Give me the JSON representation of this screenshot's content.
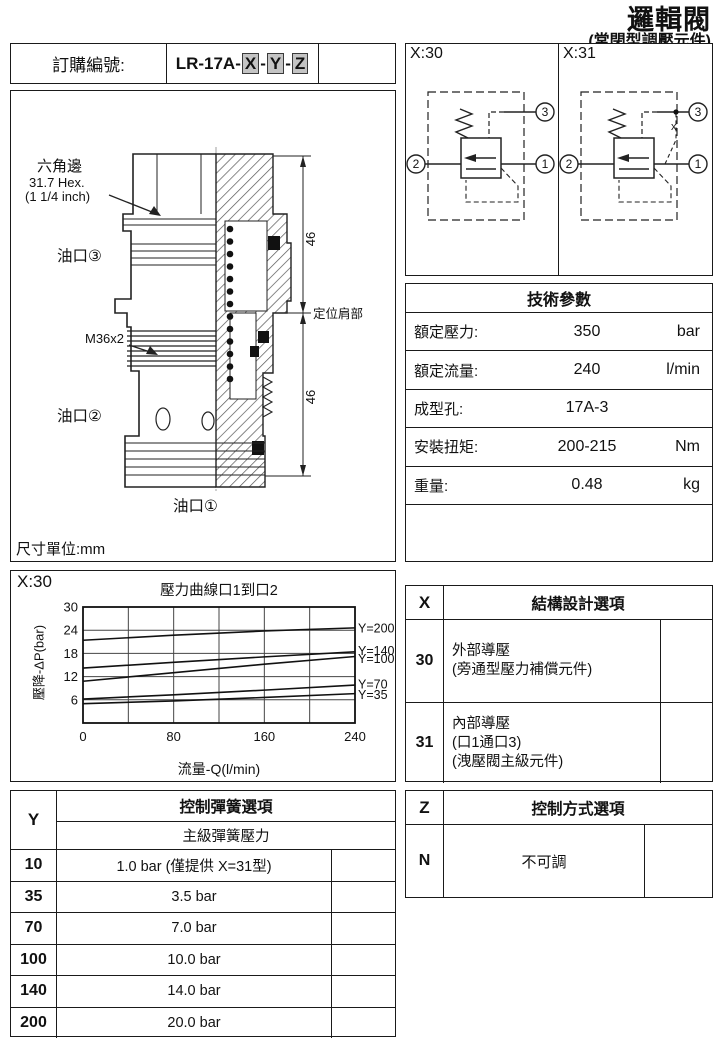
{
  "page": {
    "title": "邏輯閥",
    "subtitle": "(常閉型調壓元件)"
  },
  "order": {
    "label": "訂購編號:",
    "code_prefix": "LR-17A-",
    "code_x": "X",
    "sep1": "-",
    "code_y": "Y",
    "sep2": "-",
    "code_z": "Z"
  },
  "drawing": {
    "hex_label_line1": "六角邊",
    "hex_label_line2": "31.7 Hex.",
    "hex_label_line3": "(1 1/4 inch)",
    "thread_label": "M36x2",
    "port3_label": "油口③",
    "port2_label": "油口②",
    "port1_label": "油口①",
    "dim_top": "46",
    "dim_bottom": "46",
    "shoulder_label": "定位肩部",
    "unit_note": "尺寸單位:mm"
  },
  "schematics": {
    "left_label": "X:30",
    "right_label": "X:31",
    "port1": "1",
    "port2": "2",
    "port3": "3",
    "x31_mark": "x"
  },
  "tech_params": {
    "title": "技術參數",
    "rows": [
      {
        "label": "額定壓力:",
        "value": "350",
        "unit": "bar"
      },
      {
        "label": "額定流量:",
        "value": "240",
        "unit": "l/min"
      },
      {
        "label": "成型孔:",
        "value": "17A-3",
        "unit": ""
      },
      {
        "label": "安裝扭矩:",
        "value": "200-215",
        "unit": "Nm"
      },
      {
        "label": "重量:",
        "value": "0.48",
        "unit": "kg"
      }
    ]
  },
  "chart_box_label": "X:30",
  "chart_data": {
    "type": "line",
    "title": "壓力曲線口1到口2",
    "xlabel": "流量-Q(l/min)",
    "ylabel": "壓降-ΔP(bar)",
    "xlim": [
      0,
      240
    ],
    "ylim": [
      0,
      30
    ],
    "x_ticks": [
      0,
      80,
      160,
      240
    ],
    "y_ticks": [
      6,
      12,
      18,
      24,
      30
    ],
    "x_grid_step": 40,
    "y_grid_step": 6,
    "grid": true,
    "legend_position": "right-of-lines",
    "x": [
      0,
      80,
      160,
      240
    ],
    "series": [
      {
        "name": "Y=200",
        "values": [
          21.4,
          22.7,
          23.8,
          24.6
        ],
        "label_y": 24.4
      },
      {
        "name": "Y=140",
        "values": [
          14.2,
          15.7,
          17.1,
          18.4
        ],
        "label_y": 18.6
      },
      {
        "name": "Y=100",
        "values": [
          10.8,
          13.0,
          15.2,
          17.2
        ],
        "label_y": 16.5
      },
      {
        "name": "Y=70",
        "values": [
          6.2,
          7.3,
          8.5,
          9.8
        ],
        "label_y": 9.9
      },
      {
        "name": "Y=35",
        "values": [
          5.0,
          5.7,
          6.6,
          7.6
        ],
        "label_y": 7.2
      }
    ]
  },
  "x_options": {
    "col_header": "X",
    "title": "結構設計選項",
    "rows": [
      {
        "code": "30",
        "line1": "外部導壓",
        "line2": "(旁通型壓力補償元件)"
      },
      {
        "code": "31",
        "line1": "內部導壓",
        "line2": "(口1通口3)",
        "line3": "(洩壓閥主級元件)"
      }
    ]
  },
  "y_options": {
    "col_header": "Y",
    "title": "控制彈簧選項",
    "subtitle": "主級彈簧壓力",
    "rows": [
      {
        "code": "10",
        "value": "1.0 bar  (僅提供 X=31型)"
      },
      {
        "code": "35",
        "value": "3.5 bar"
      },
      {
        "code": "70",
        "value": "7.0 bar"
      },
      {
        "code": "100",
        "value": "10.0 bar"
      },
      {
        "code": "140",
        "value": "14.0 bar"
      },
      {
        "code": "200",
        "value": "20.0 bar"
      }
    ]
  },
  "z_options": {
    "col_header": "Z",
    "title": "控制方式選項",
    "rows": [
      {
        "code": "N",
        "value": "不可調"
      }
    ]
  },
  "colors": {
    "ink": "#111111",
    "option_box_bg": "#c4c4c4"
  }
}
